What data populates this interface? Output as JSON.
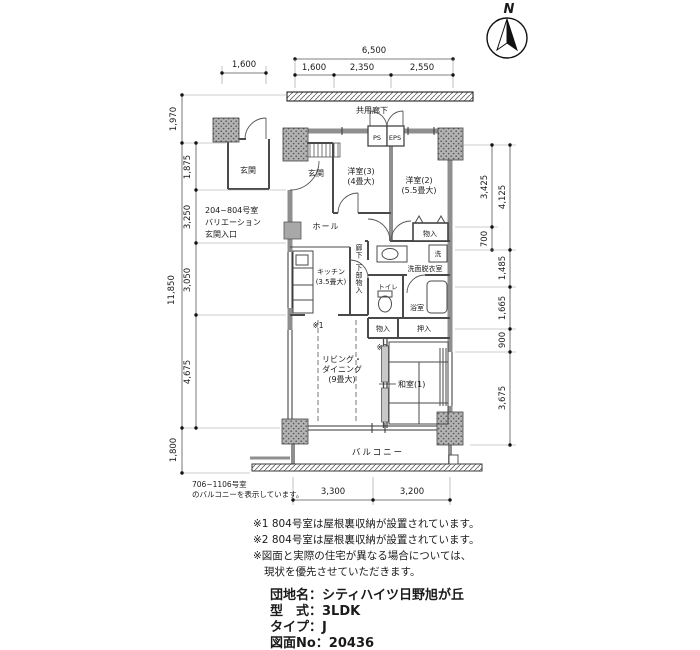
{
  "compass": {
    "north_label": "N"
  },
  "corridor_label": "共用廊下",
  "dimensions": {
    "top": {
      "entry_width": "1,600",
      "total": "6,500",
      "segments": [
        "1,600",
        "2,350",
        "2,550"
      ]
    },
    "left": {
      "outer_top": "1,970",
      "outer_total": "11,850",
      "outer_bottom": "1,800",
      "inner": [
        "1,875",
        "3,250",
        "3,050",
        "4,675"
      ]
    },
    "right": {
      "inner": [
        "3,425",
        "700"
      ],
      "outer": [
        "4,125",
        "1,485",
        "1,665",
        "900",
        "3,675"
      ]
    },
    "bottom": [
      "3,300",
      "3,200"
    ]
  },
  "rooms": {
    "genkan_main": "玄関",
    "genkan_variation": "玄関",
    "western3_name": "洋室(3)",
    "western3_size": "(4畳大)",
    "western2_name": "洋室(2)",
    "western2_size": "(5.5畳大)",
    "hall": "ホール",
    "kitchen_name": "キッチン",
    "kitchen_size": "(3.5畳大)",
    "corridor": "廊下",
    "under_storage": "下部物入",
    "toilet": "トイレ",
    "washroom": "洗面脱衣室",
    "washer": "洗",
    "bathroom": "浴室",
    "storage_upper": "物入",
    "storage_mid": "物入",
    "oshiire": "押入",
    "japanese1": "和室(1)",
    "living_line1": "リビング・",
    "living_line2": "ダイニング",
    "living_size": "(9畳大)",
    "balcony": "バルコニー",
    "ps": "PS",
    "eps": "EPS"
  },
  "markers": {
    "note1": "※1",
    "note2": "※2"
  },
  "variation_note": {
    "line1": "204~804号室",
    "line2": "バリエーション",
    "line3": "玄関入口"
  },
  "balcony_note": {
    "line1": "706~1106号室",
    "line2": "のバルコニーを表示しています。"
  },
  "notes": [
    "※1 804号室は屋根裏収納が設置されています。",
    "※2 804号室は屋根裏収納が設置されています。",
    "※図面と実際の住宅が異なる場合については、",
    "現状を優先させていただきます。"
  ],
  "title_block": {
    "complex": "団地名：シティハイツ日野旭が丘",
    "type": "型　式：3LDK",
    "plan_type": "タイプ：J",
    "drawing_no": "図面No：20436"
  }
}
